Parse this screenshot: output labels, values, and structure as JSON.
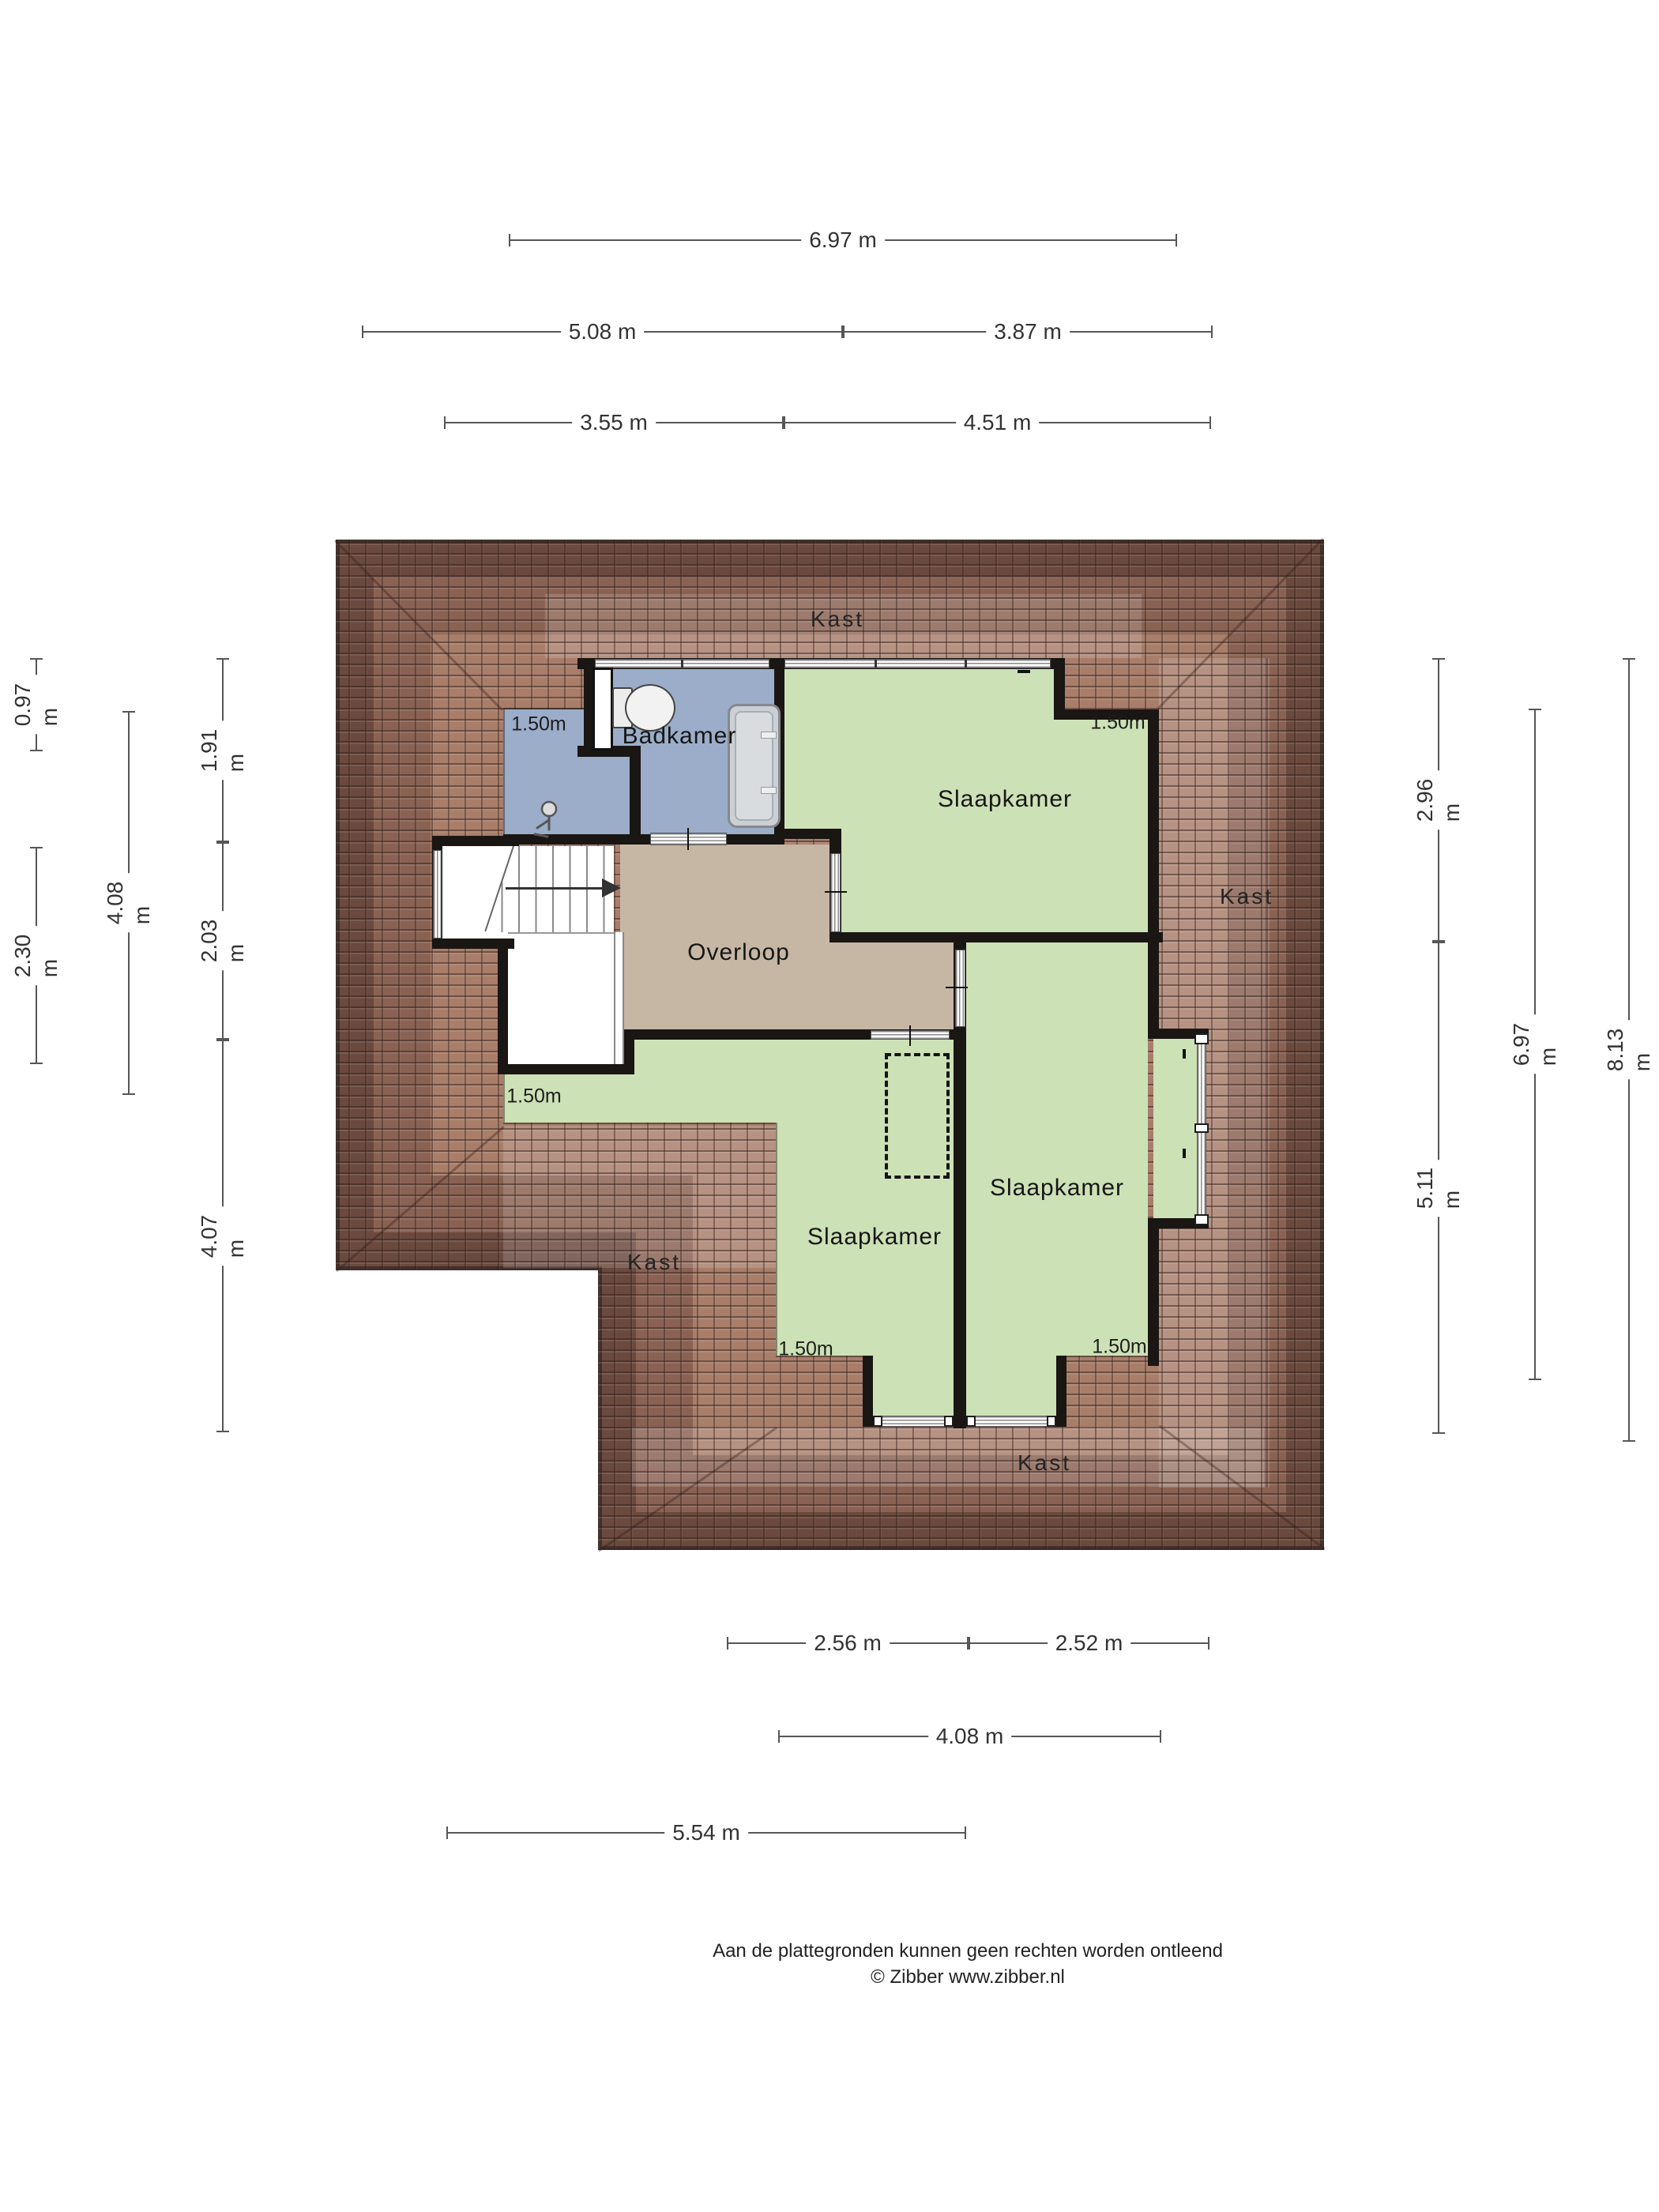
{
  "rooms": {
    "badkamer": {
      "label": "Badkamer"
    },
    "slaapkamer_tr": {
      "label": "Slaapkamer"
    },
    "overloop": {
      "label": "Overloop"
    },
    "slaapkamer_bm": {
      "label": "Slaapkamer"
    },
    "slaapkamer_br": {
      "label": "Slaapkamer"
    }
  },
  "closets": {
    "top": "Kast",
    "right": "Kast",
    "left": "Kast",
    "bottom": "Kast"
  },
  "knee_wall_labels": {
    "badkamer": "1.50m",
    "slaapkamer_tr": "1.50m",
    "landing": "1.50m",
    "slaapkamer_bm": "1.50m",
    "slaapkamer_br": "1.50m"
  },
  "dimensions": {
    "top": [
      {
        "label": "6.97 m"
      },
      {
        "label": "5.08 m"
      },
      {
        "label": "3.87 m"
      },
      {
        "label": "3.55 m"
      },
      {
        "label": "4.51 m"
      }
    ],
    "left": [
      {
        "label": "0.97 m"
      },
      {
        "label": "2.30 m"
      },
      {
        "label": "4.08 m"
      },
      {
        "label": "1.91 m"
      },
      {
        "label": "2.03 m"
      },
      {
        "label": "4.07 m"
      }
    ],
    "right": [
      {
        "label": "2.96 m"
      },
      {
        "label": "5.11 m"
      },
      {
        "label": "6.97 m"
      },
      {
        "label": "8.13 m"
      }
    ],
    "bottom": [
      {
        "label": "2.56 m"
      },
      {
        "label": "2.52 m"
      },
      {
        "label": "4.08 m"
      },
      {
        "label": "5.54 m"
      }
    ]
  },
  "footer": {
    "line1": "Aan de plattegronden kunnen geen rechten worden ontleend",
    "line2": "© Zibber www.zibber.nl"
  },
  "colors": {
    "bedroom_green": "#cde1b6",
    "bathroom_blue": "#9badc9",
    "landing_tan": "#c6b7a5",
    "roof_dark": "#6a493e",
    "roof_mid": "#8a6253",
    "roof_light": "#a87e6b",
    "wall": "#191613"
  }
}
